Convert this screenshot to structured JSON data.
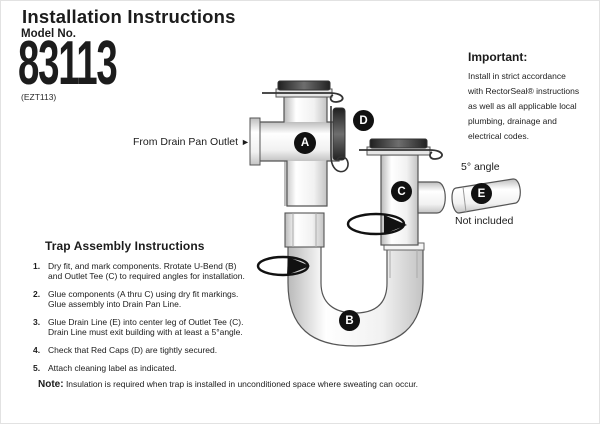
{
  "header": {
    "title": "Installation Instructions",
    "model_label": "Model No.",
    "model_number": "83113",
    "model_code": "(EZT113)"
  },
  "important": {
    "heading": "Important:",
    "lines": [
      "Install in strict accordance",
      "with RectorSeal® instructions",
      "as well as all applicable local",
      "plumbing, drainage and",
      "electrical codes."
    ]
  },
  "diagram": {
    "inlet_label": "From Drain Pan Outlet",
    "inlet_arrow": "►",
    "angle_label": "5° angle",
    "not_included_label": "Not included",
    "part_labels": {
      "a": "A",
      "b": "B",
      "c": "C",
      "d": "D",
      "e": "E"
    }
  },
  "instructions": {
    "heading": "Trap Assembly Instructions",
    "steps": [
      {
        "num": "1.",
        "lines": [
          "Dry fit, and mark components. Rrotate U-Bend (B)",
          "and Outlet Tee (C) to required angles for installation."
        ]
      },
      {
        "num": "2.",
        "lines": [
          "Glue components (A thru C) using dry fit markings.",
          "Glue assembly into Drain Pan Line."
        ]
      },
      {
        "num": "3.",
        "lines": [
          "Glue Drain Line (E) into center leg of Outlet Tee (C).",
          "Drain Line must exit building with at least a 5°angle."
        ]
      },
      {
        "num": "4.",
        "lines": [
          "Check that Red Caps (D) are tightly secured."
        ]
      },
      {
        "num": "5.",
        "lines": [
          "Attach cleaning label as indicated."
        ]
      }
    ],
    "note_label": "Note:",
    "note_text": "Insulation is required when trap is installed in unconditioned space where sweating can occur."
  },
  "colors": {
    "text": "#1c1c1c",
    "badge_bg": "#111111",
    "badge_text": "#ffffff",
    "pipe_outline": "#555555",
    "cap_dark": "#2b2b2b",
    "background": "#ffffff"
  }
}
